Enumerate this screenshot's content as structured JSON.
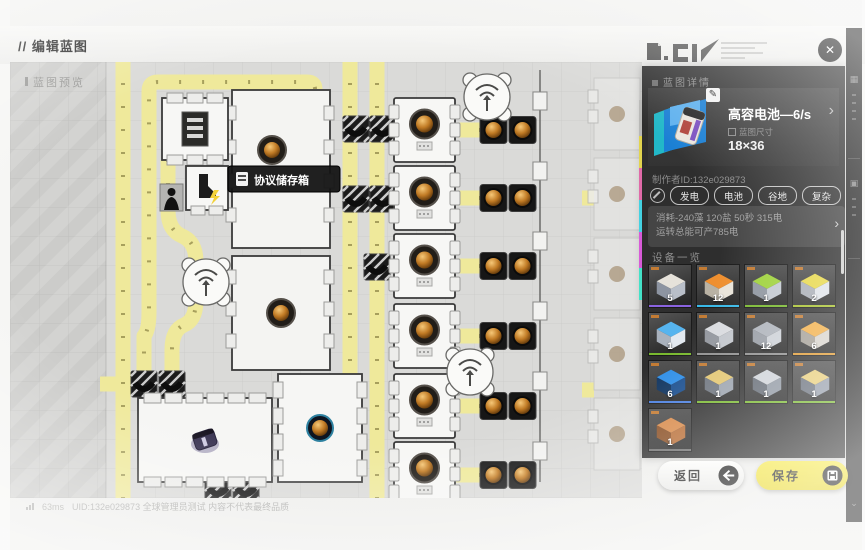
{
  "header": {
    "title": "// 编辑蓝图",
    "close_glyph": "✕"
  },
  "map": {
    "preview_label": "蓝图预览",
    "tooltip_label": "协议储存箱"
  },
  "panel": {
    "section_title": "蓝图详情",
    "item_name": "高容电池—6/s",
    "size_label": "蓝图尺寸",
    "size_value": "18×36",
    "creator": "制作者ID:132e029873",
    "chevron": "›",
    "tags": [
      "发电",
      "电池",
      "谷地",
      "复杂"
    ],
    "stats_line1": "消耗-240藻 120盐 50秒 315电",
    "stats_line2": "运转总能可产785电",
    "equipment_title": "设备一览",
    "equipment": {
      "items": [
        {
          "count": "5",
          "q": "#8a63e0",
          "a": "#e6e2da",
          "m": "#b9bfc9",
          "d": "#8d94a1"
        },
        {
          "count": "12",
          "q": "#38b9e8",
          "a": "#ef8f2f",
          "m": "#e9e4da",
          "d": "#b9b2a4"
        },
        {
          "count": "1",
          "q": "#79b92f",
          "a": "#9fd23c",
          "m": "#c3c9d1",
          "d": "#8f96a0"
        },
        {
          "count": "2",
          "q": "#a8c22e",
          "a": "#e7d84a",
          "m": "#dfe3e8",
          "d": "#a9aeb6"
        },
        {
          "count": "1",
          "q": "#79b92f",
          "a": "#56b4ef",
          "m": "#e3e9f0",
          "d": "#aab2bd"
        },
        {
          "count": "1",
          "q": "#8f8f8f",
          "a": "#d9dbdf",
          "m": "#c2c6cc",
          "d": "#93979e"
        },
        {
          "count": "12",
          "q": "#8f8f8f",
          "a": "#aeb3bb",
          "m": "#cdd1d7",
          "d": "#989da5"
        },
        {
          "count": "6",
          "q": "#e09a31",
          "a": "#f2b04a",
          "m": "#d8d4cd",
          "d": "#a49f96"
        },
        {
          "count": "6",
          "q": "#4a7fe0",
          "a": "#2f8fe8",
          "m": "#1b4f8f",
          "d": "#10345f"
        },
        {
          "count": "1",
          "q": "#79b92f",
          "a": "#e3c670",
          "m": "#9aa2ad",
          "d": "#6d747e"
        },
        {
          "count": "1",
          "q": "#79b92f",
          "a": "#cfd3d9",
          "m": "#8f97a2",
          "d": "#646b75"
        },
        {
          "count": "1",
          "q": "#79b92f",
          "a": "#e8cd79",
          "m": "#949caa",
          "d": "#686f7b"
        },
        {
          "count": "1",
          "q": "#6f6f6f",
          "a": "#d88a4a",
          "m": "#b96f38",
          "d": "#8a4f24"
        }
      ]
    }
  },
  "buttons": {
    "back": "返回",
    "save": "保存"
  },
  "status_bar": {
    "ping": "63ms",
    "text": "UID:132e029873 全球管理员测试 内容不代表最终品质"
  },
  "colors": {
    "accent_yellow": "#f0e13c",
    "belt_yellow": "#efe99b",
    "panel_bg": "#2e2e2e"
  }
}
